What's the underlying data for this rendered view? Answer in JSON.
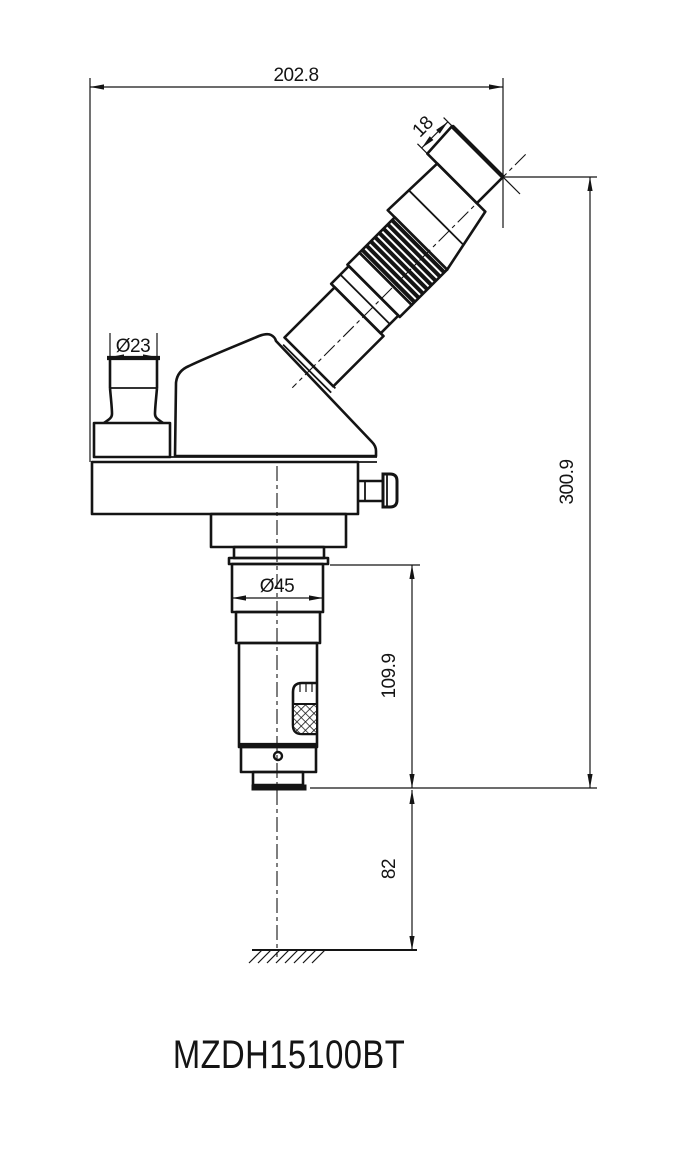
{
  "drawing": {
    "title": "MZDH15100BT",
    "dimensions": {
      "overall_width": "202.8",
      "eyecup_height": "18",
      "photo_port_diameter": "Ø23",
      "mount_diameter": "Ø45",
      "overall_height": "300.9",
      "body_length": "109.9",
      "working_distance": "82"
    },
    "colors": {
      "line": "#141414",
      "background": "#ffffff"
    }
  }
}
